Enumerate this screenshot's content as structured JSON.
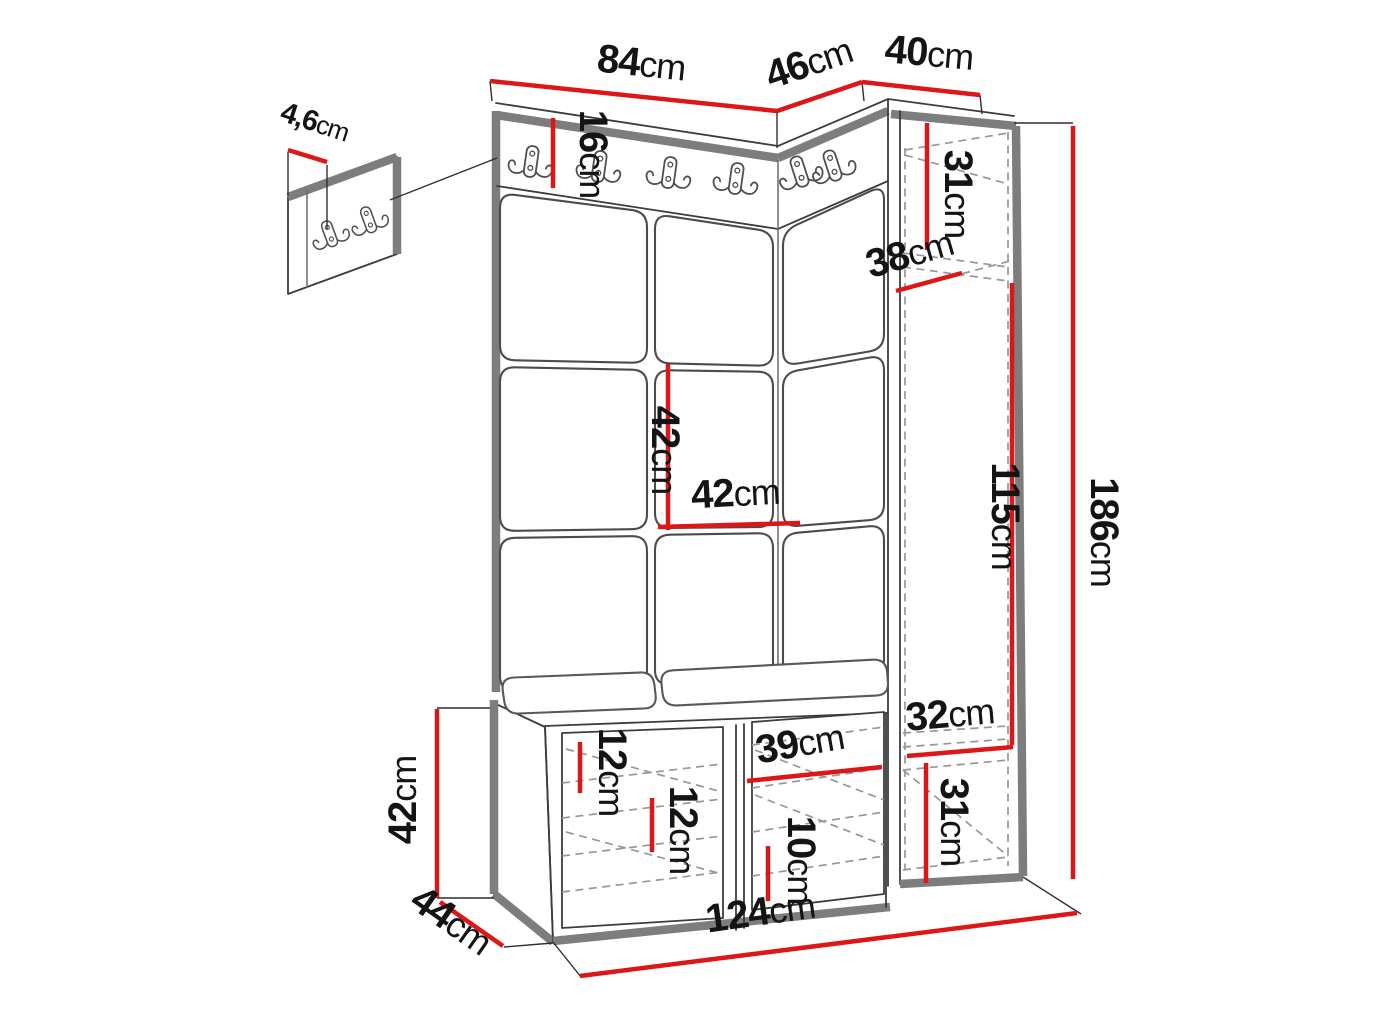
{
  "diagram_title": "hallway-furniture-set-dimension-diagram",
  "unit_suffix": "cm",
  "colors": {
    "dimension": "#dc1717",
    "outline": "#7d7d7d",
    "line": "#3c3c3c",
    "dashed": "#979797",
    "text": "#141414"
  },
  "dimensions": {
    "wall_section_width": "84",
    "corner_section_width": "46",
    "cabinet_section_width": "40",
    "hook_panel_depth": "4,6",
    "top_rail_height": "16",
    "cabinet_upper_compartment_height": "31",
    "cabinet_shelf_depth": "38",
    "panel_height": "42",
    "panel_width": "42",
    "cabinet_open_section_height": "115",
    "total_height": "186",
    "cabinet_inner_width": "32",
    "cabinet_lower_compartment_height": "31",
    "bench_upper_shelf_gap": "12",
    "bench_shelf_spacing": "12",
    "bench_compartment_width": "39",
    "bench_lower_shelf_gap": "10",
    "bench_height": "42",
    "bench_depth": "44",
    "total_width": "124"
  }
}
